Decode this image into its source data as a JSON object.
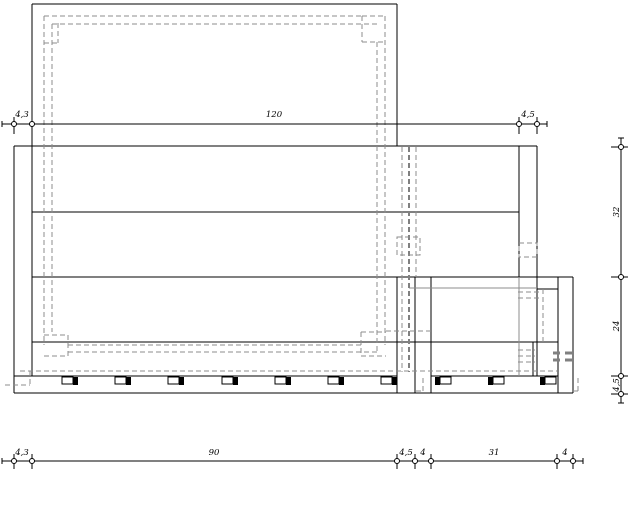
{
  "drawing": {
    "type": "cad-furniture-elevation",
    "colors": {
      "line": "#000000",
      "hidden": "#8c8c8c",
      "hidden_bold": "#808080",
      "background": "#ffffff"
    },
    "dims": {
      "top": {
        "d1": "4,3",
        "d2": "120",
        "d3": "4,5"
      },
      "bottom": {
        "d1": "4,3",
        "d2": "90",
        "d3": "4,5",
        "d4": "4",
        "d5": "31",
        "d6": "4"
      },
      "right": {
        "d1": "32",
        "d2": "24",
        "d3": "4,5"
      }
    }
  }
}
